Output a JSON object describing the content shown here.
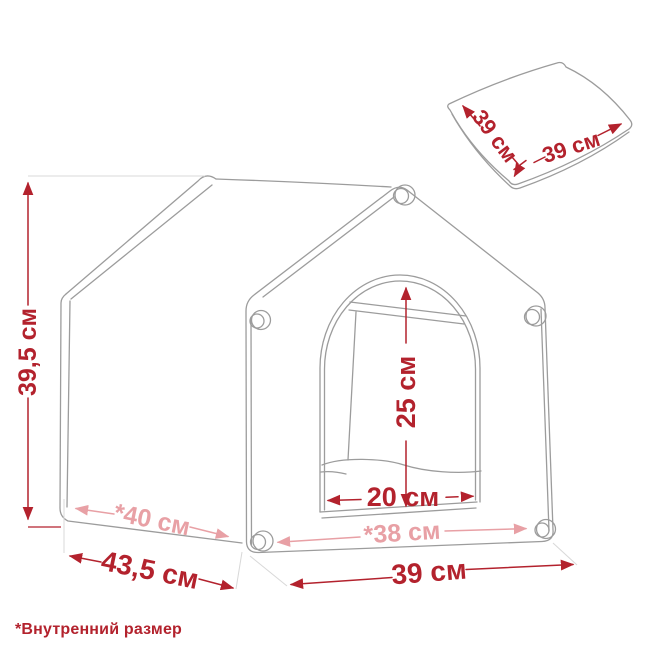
{
  "page": {
    "type": "product-dimensions-diagram",
    "subject": "pet house with removable cushion",
    "background": "#ffffff"
  },
  "colors": {
    "dimension_red": "#b3222d",
    "dimension_pink": "#e8a0a5",
    "outline_gray": "#9c9c9c",
    "extension_gray": "#d8d8d8"
  },
  "house": {
    "height": {
      "label": "39,5 см"
    },
    "depth": {
      "label": "43,5 см"
    },
    "width": {
      "label": "39 см"
    },
    "internal_depth": {
      "label": "*40 см"
    },
    "internal_width": {
      "label": "*38 см"
    },
    "door": {
      "height_label": "25 см",
      "width_label": "20 см"
    }
  },
  "cushion": {
    "side_a_label": "39 см",
    "side_b_label": "39 см"
  },
  "footnote": "*Внутренний размер"
}
